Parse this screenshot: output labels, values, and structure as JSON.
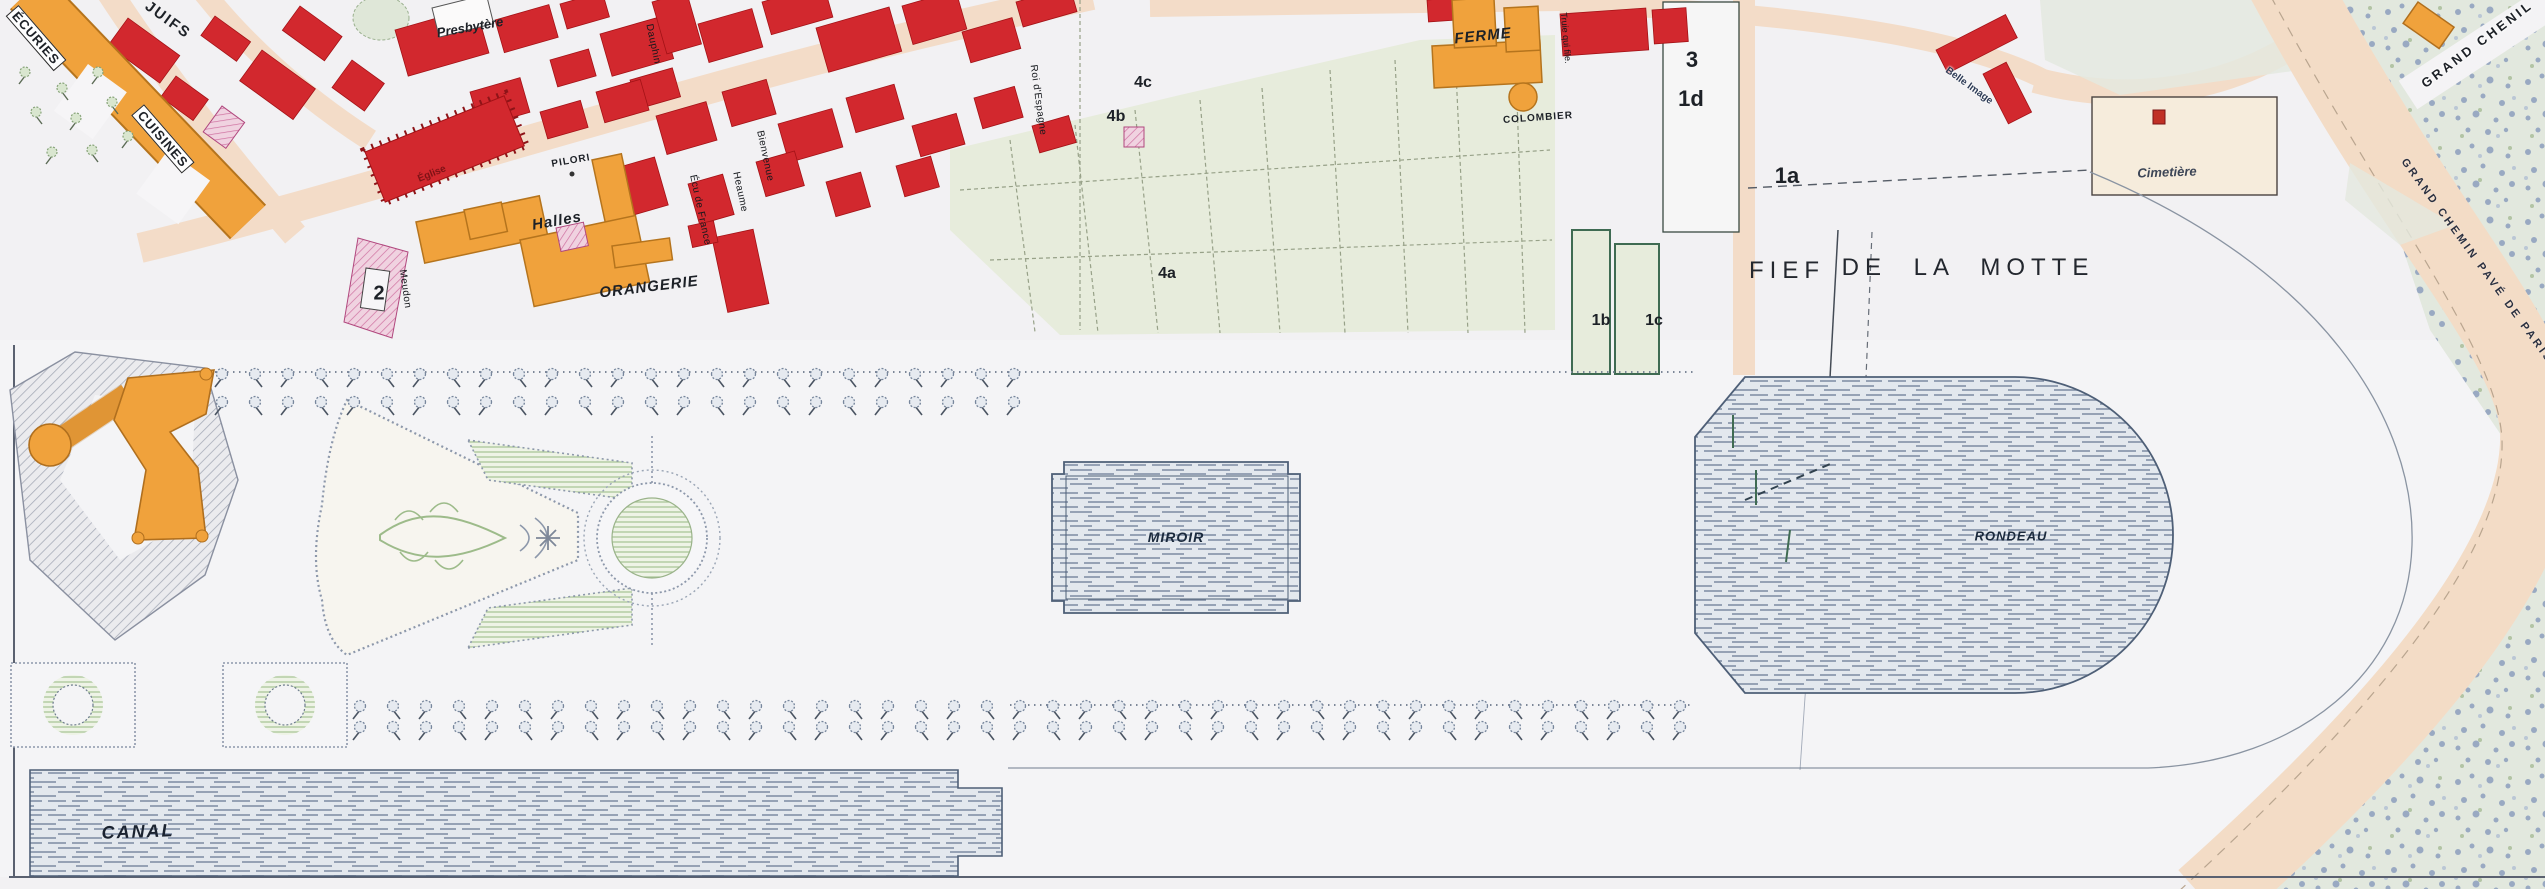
{
  "plan": {
    "type": "historical-estate-plan",
    "features": [
      "village",
      "chateau",
      "gardens",
      "water-basins",
      "woods",
      "roads"
    ]
  },
  "colors": {
    "village_building_red": "#d2282e",
    "estate_building_orange": "#f0a23c",
    "special_building_pink": "#f0d2e0",
    "street_peach": "#f3dcc8",
    "field_green": "#e7ecdc",
    "water_blue_gray": "#e3e8ee",
    "woods_blue_green": "#e2e8de",
    "paper": "#f2f1f3",
    "label_ink": "#1d2127"
  },
  "labels": [
    {
      "id": "street-juifs",
      "text": "JUIFS",
      "x": 168,
      "y": 20,
      "rot": 36,
      "cls": "caps15"
    },
    {
      "id": "ecuries",
      "text": "ÉCURIES",
      "x": 36,
      "y": 38,
      "rot": 49,
      "cls": "strip"
    },
    {
      "id": "cuisines",
      "text": "CUISINES",
      "x": 163,
      "y": 139,
      "rot": 49,
      "cls": "strip"
    },
    {
      "id": "presbytere",
      "text": "Presbytère",
      "x": 470,
      "y": 27,
      "rot": -10,
      "cls": "it13"
    },
    {
      "id": "eglise",
      "text": "Église",
      "x": 432,
      "y": 174,
      "rot": -22,
      "cls": "onred"
    },
    {
      "id": "pilori",
      "text": "PILORI",
      "x": 571,
      "y": 161,
      "rot": -10,
      "cls": "caps10"
    },
    {
      "id": "halles",
      "text": "Halles",
      "x": 557,
      "y": 221,
      "rot": -10,
      "cls": "it15"
    },
    {
      "id": "orangerie",
      "text": "ORANGERIE",
      "x": 649,
      "y": 287,
      "rot": -7,
      "cls": "it15"
    },
    {
      "id": "parcel-2",
      "text": "2",
      "x": 379,
      "y": 294,
      "rot": 0,
      "cls": "num20"
    },
    {
      "id": "street-meudon",
      "text": "Meudon",
      "x": 405,
      "y": 289,
      "rot": 82,
      "cls": "street10"
    },
    {
      "id": "street-dauphin",
      "text": "Dauphin",
      "x": 653,
      "y": 44,
      "rot": 78,
      "cls": "street10"
    },
    {
      "id": "street-ecu-de-france",
      "text": "Écu de France",
      "x": 700,
      "y": 210,
      "rot": 78,
      "cls": "street10"
    },
    {
      "id": "street-heaume",
      "text": "Heaume",
      "x": 740,
      "y": 192,
      "rot": 78,
      "cls": "street10"
    },
    {
      "id": "street-bienvenue",
      "text": "Bienvenue",
      "x": 765,
      "y": 156,
      "rot": 78,
      "cls": "street10"
    },
    {
      "id": "street-roi-espagne",
      "text": "Roi d'Espagne",
      "x": 1038,
      "y": 100,
      "rot": 82,
      "cls": "street10"
    },
    {
      "id": "parcel-4c",
      "text": "4c",
      "x": 1143,
      "y": 83,
      "rot": 0,
      "cls": "num16"
    },
    {
      "id": "parcel-4b",
      "text": "4b",
      "x": 1116,
      "y": 117,
      "rot": 0,
      "cls": "num16"
    },
    {
      "id": "parcel-4a",
      "text": "4a",
      "x": 1167,
      "y": 274,
      "rot": 0,
      "cls": "num16"
    },
    {
      "id": "ferme",
      "text": "FERME",
      "x": 1483,
      "y": 36,
      "rot": -6,
      "cls": "it15"
    },
    {
      "id": "colombier",
      "text": "COLOMBIER",
      "x": 1538,
      "y": 118,
      "rot": -4,
      "cls": "caps10"
    },
    {
      "id": "street-truie-qui-file",
      "text": "Truie qui file.",
      "x": 1566,
      "y": 38,
      "rot": 85,
      "cls": "street9"
    },
    {
      "id": "parcel-3",
      "text": "3",
      "x": 1692,
      "y": 60,
      "rot": 0,
      "cls": "num22"
    },
    {
      "id": "parcel-1d",
      "text": "1d",
      "x": 1691,
      "y": 99,
      "rot": 0,
      "cls": "num22"
    },
    {
      "id": "parcel-1a",
      "text": "1a",
      "x": 1787,
      "y": 176,
      "rot": 0,
      "cls": "num22"
    },
    {
      "id": "parcel-1b",
      "text": "1b",
      "x": 1601,
      "y": 321,
      "rot": 0,
      "cls": "num16"
    },
    {
      "id": "parcel-1c",
      "text": "1c",
      "x": 1654,
      "y": 321,
      "rot": 0,
      "cls": "num16"
    },
    {
      "id": "fief",
      "text": "FIEF",
      "x": 1787,
      "y": 271,
      "rot": 0,
      "cls": "big22"
    },
    {
      "id": "de-la-motte",
      "text": "DE LA MOTTE",
      "x": 1968,
      "y": 268,
      "rot": 0,
      "cls": "big22sp"
    },
    {
      "id": "cimetiere",
      "text": "Cimetière",
      "x": 2167,
      "y": 172,
      "rot": -2,
      "cls": "it13b"
    },
    {
      "id": "belle-image",
      "text": "Belle Image",
      "x": 1969,
      "y": 86,
      "rot": 36,
      "cls": "tiny10"
    },
    {
      "id": "grand-chenil",
      "text": "GRAND CHENIL",
      "x": 2477,
      "y": 44,
      "rot": -37,
      "cls": "caps13sp"
    },
    {
      "id": "grand-chemin-pave",
      "text": "GRAND CHEMIN PAVÉ DE PARIS À",
      "x": 2482,
      "y": 268,
      "rot": 54,
      "cls": "caps11sp"
    },
    {
      "id": "miroir",
      "text": "MIROIR",
      "x": 1176,
      "y": 537,
      "rot": 0,
      "cls": "it14d"
    },
    {
      "id": "rondeau",
      "text": "RONDEAU",
      "x": 2011,
      "y": 536,
      "rot": 0,
      "cls": "it13d"
    },
    {
      "id": "canal",
      "text": "CANAL",
      "x": 138,
      "y": 832,
      "rot": -2,
      "cls": "it18d"
    }
  ]
}
